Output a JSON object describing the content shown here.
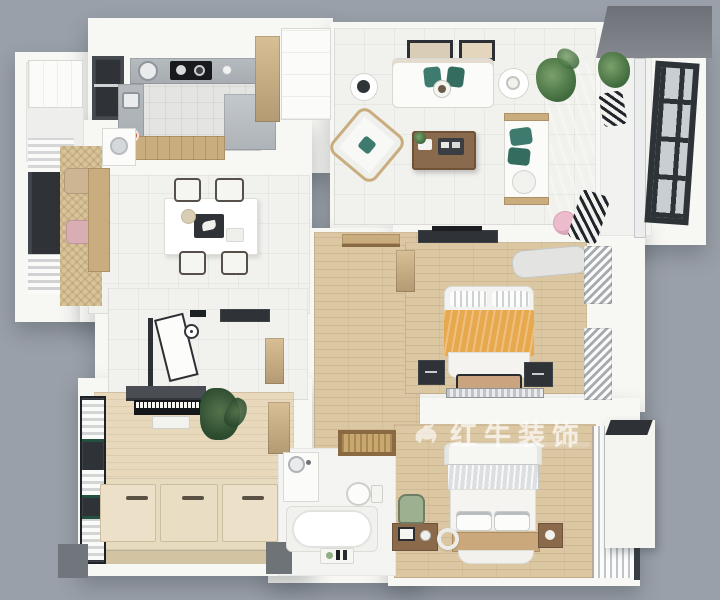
{
  "watermark": {
    "icon": "bull-icon",
    "text": "红牛装饰"
  },
  "palette": {
    "background": "#9aa0a9",
    "wall": "#f7f7f4",
    "tile_floor": "#f1f1ee",
    "kitchen_tile": "#e4e5e3",
    "wood_floor": "#dcc7a3",
    "tatami": "#e6dabf",
    "counter_gray": "#aeb3b8",
    "window_frame_dark": "#2f3338",
    "roof_slab": "#74787e",
    "pillow_teal": "#3e7a6d",
    "blanket_orange": "#e8a84e",
    "pouf_pink": "#ecbccd",
    "plant_green": "#4f7b4a",
    "wood_furniture": "#8a6a4b",
    "cabinet_champagne": "#c3a87f"
  },
  "rooms": {
    "kitchen": {
      "items": [
        "window",
        "counter",
        "round-sink",
        "cooktop",
        "side-sink",
        "island",
        "tall-cabinet",
        "breakfast-bar",
        "washer",
        "kettle"
      ]
    },
    "utility_room": {
      "items": [
        "cabinet"
      ]
    },
    "living_room": {
      "items": [
        "wall-frames",
        "sofa",
        "teal-pillows",
        "side-tables",
        "palm-plant",
        "armchair",
        "coffee-table",
        "loveseat",
        "pink-pouf",
        "striped-lounge"
      ]
    },
    "balcony": {
      "items": [
        "roof-slab",
        "open-grid-window",
        "railing",
        "plant",
        "striped-chair"
      ]
    },
    "dining_area": {
      "items": [
        "bay-window",
        "curtains",
        "bench-cushions",
        "pink-cushion",
        "wood-bench",
        "table",
        "tray",
        "four-chairs"
      ]
    },
    "foyer": {
      "items": [
        "open-door",
        "wall-clock",
        "dark-console",
        "gold-cabinet"
      ]
    },
    "hallway": {
      "items": [
        "wall-shelf"
      ]
    },
    "master_bedroom": {
      "items": [
        "tv-console",
        "wardrobe",
        "chaise",
        "striped-curtains",
        "double-bed",
        "orange-blanket",
        "nightstands",
        "foot-bench",
        "radiator-bench"
      ]
    },
    "second_bedroom": {
      "items": [
        "bed",
        "silver-fold",
        "pillows",
        "wood-footboard",
        "console",
        "picture-frame",
        "green-chair",
        "mirror-ring",
        "nightstand",
        "sheer-curtains"
      ]
    },
    "tatami_study": {
      "items": [
        "dark-shelf",
        "piano",
        "piano-bench",
        "plant",
        "wardrobe",
        "window-curtains",
        "tatami-platform",
        "storage-lids"
      ]
    },
    "bathroom": {
      "items": [
        "vanity-sink",
        "toilet",
        "bathtub",
        "toiletry-tray",
        "woven-mat"
      ]
    }
  }
}
